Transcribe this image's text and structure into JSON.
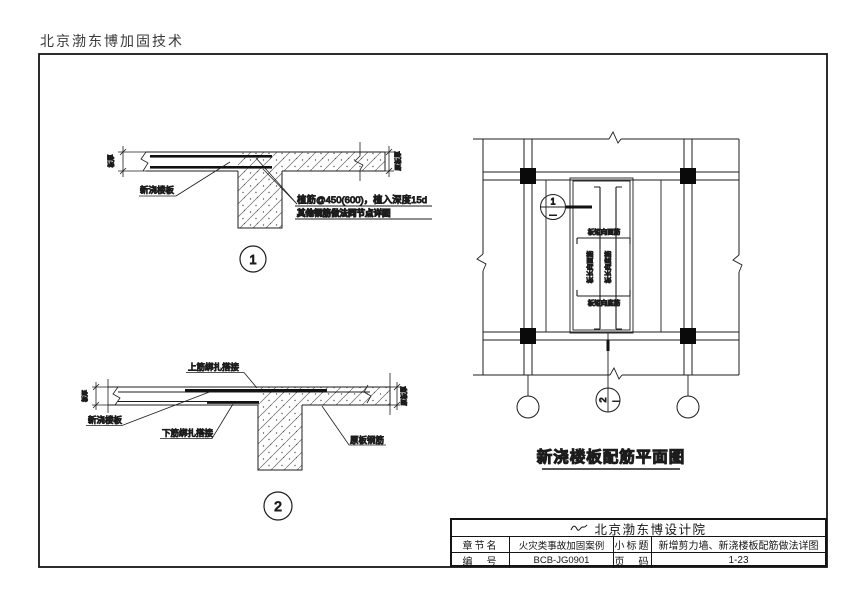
{
  "page": {
    "header_text": "北京渤东博加固技术"
  },
  "details": {
    "d1": {
      "number": "1",
      "new_slab_label": "新浇楼板",
      "anchor_note_line1": "植筋@450(600)，植入深度15d",
      "anchor_note_line2": "其他钢筋做法同节点详图",
      "dim_left": "板厚",
      "dim_right": "原板厚"
    },
    "d2": {
      "number": "2",
      "top_bar_lap_label": "上筋绑扎搭接",
      "new_slab_label": "新浇楼板",
      "bottom_bar_lap_label": "下筋绑扎搭接",
      "existing_rebar_label": "原板钢筋",
      "dim_left": "板厚",
      "dim_right": "原板厚"
    }
  },
  "plan": {
    "caption": "新浇楼板配筋平面图",
    "detail_bubble": {
      "number": "1",
      "sheet_ref": "—"
    },
    "section_mark": {
      "number": "2",
      "sheet_ref": "—"
    },
    "rebar_labels": {
      "short_dir_top": "板短向面筋",
      "short_dir_bottom": "板短向底筋",
      "long_dir_top": "板长向面筋",
      "long_dir_bottom": "板长向底筋"
    }
  },
  "title_block": {
    "company": "北京渤东博设计院",
    "row1": {
      "label1": "章节名",
      "value1": "火灾类事故加固案例",
      "label2": "小标题",
      "value2": "新增剪力墙、新浇楼板配筋做法详图"
    },
    "row2": {
      "label1": "编　号",
      "value1": "BCB-JG0901",
      "label2": "页　码",
      "value2": "1-23"
    }
  }
}
